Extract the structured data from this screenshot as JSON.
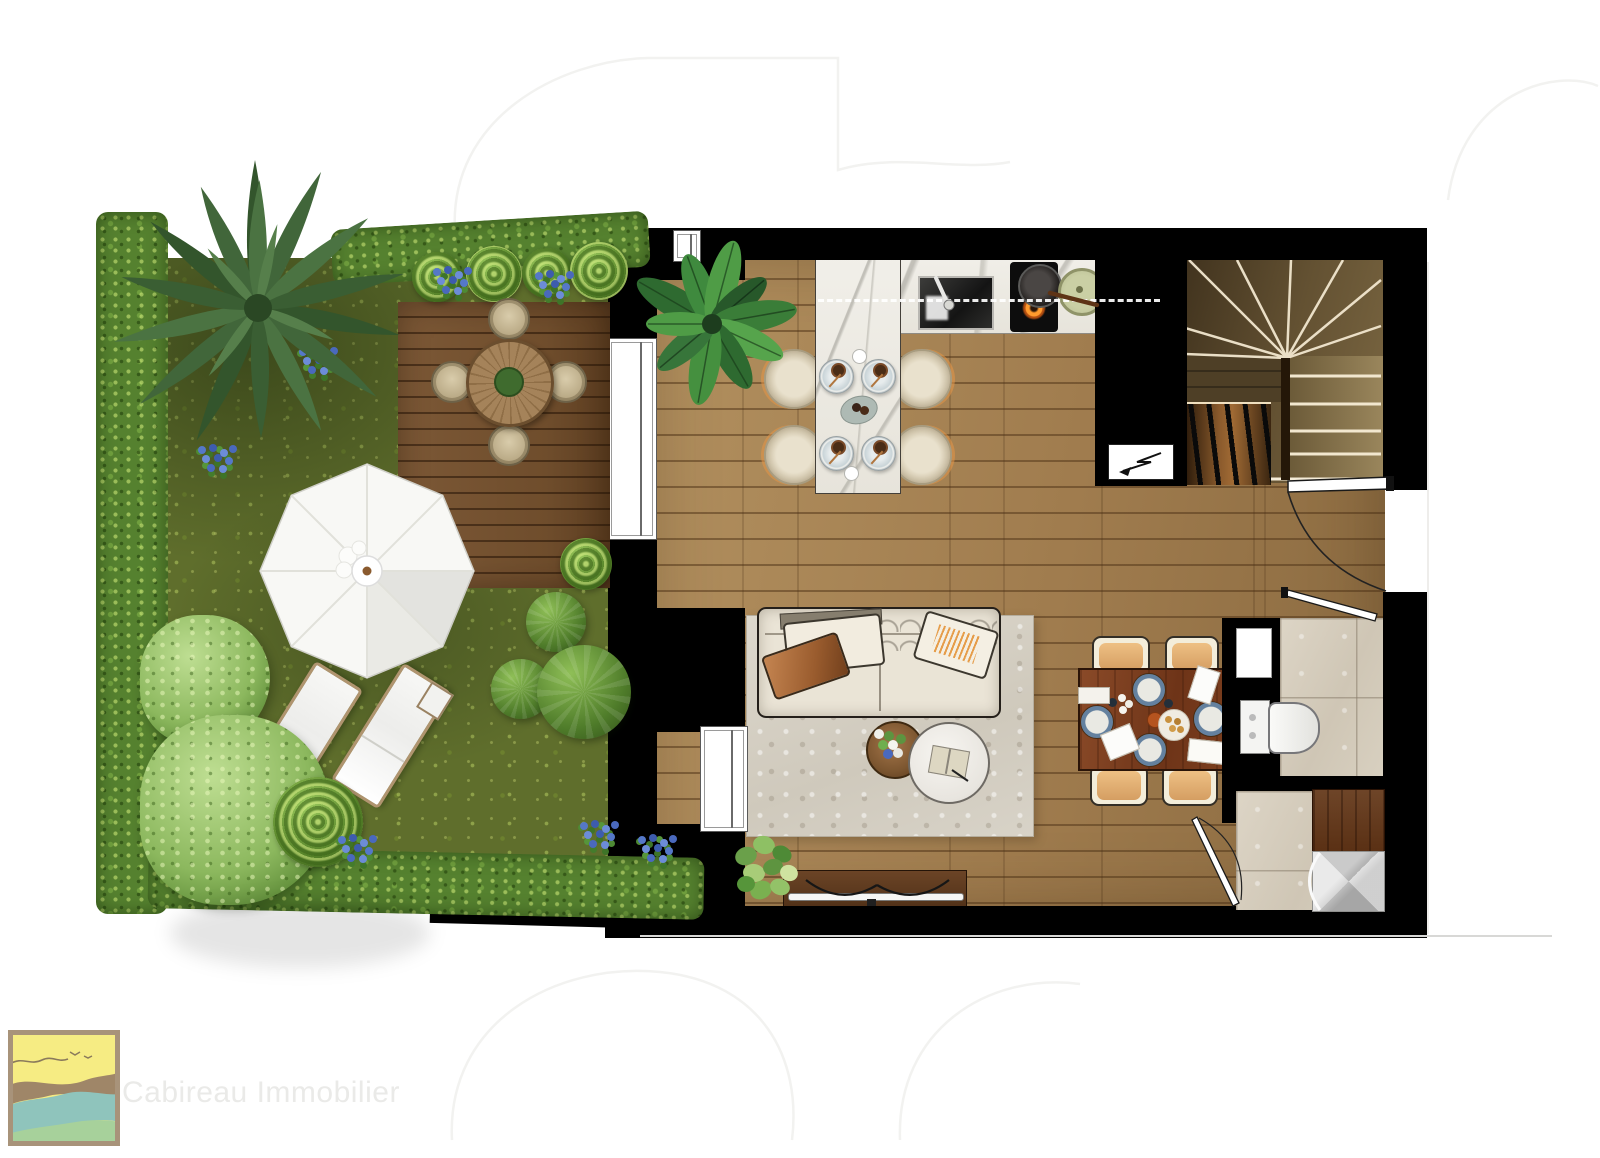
{
  "watermark": {
    "brand_name": "Cabireau Immobilier"
  },
  "logo_colors": {
    "sky": "#f6ec83",
    "wave_sand": "#9f8668",
    "wave_sea": "#8fc4bc",
    "wave_grass": "#a7d19b",
    "border": "#a8937a",
    "accent_line": "#8a7a5c"
  },
  "palette": {
    "wall": "#000000",
    "grass": "#5f6e2c",
    "hedge": "#55812f",
    "deck": "#7c5836",
    "floor_wood": "#a9885c",
    "stair_wood": "#5d4527",
    "marble": "#f1efe9",
    "rug": "#d8d3c8",
    "sofa": "#eae4d6",
    "table_wood": "#8a4a28",
    "chair_cream": "#f3edda",
    "chair_seat": "#d59e62",
    "tile": "#d8d0c2",
    "shower_wood": "#6e4528",
    "flame": "#ff9b2e",
    "flower": "#5578c8",
    "plate_blue": "#64819f"
  }
}
